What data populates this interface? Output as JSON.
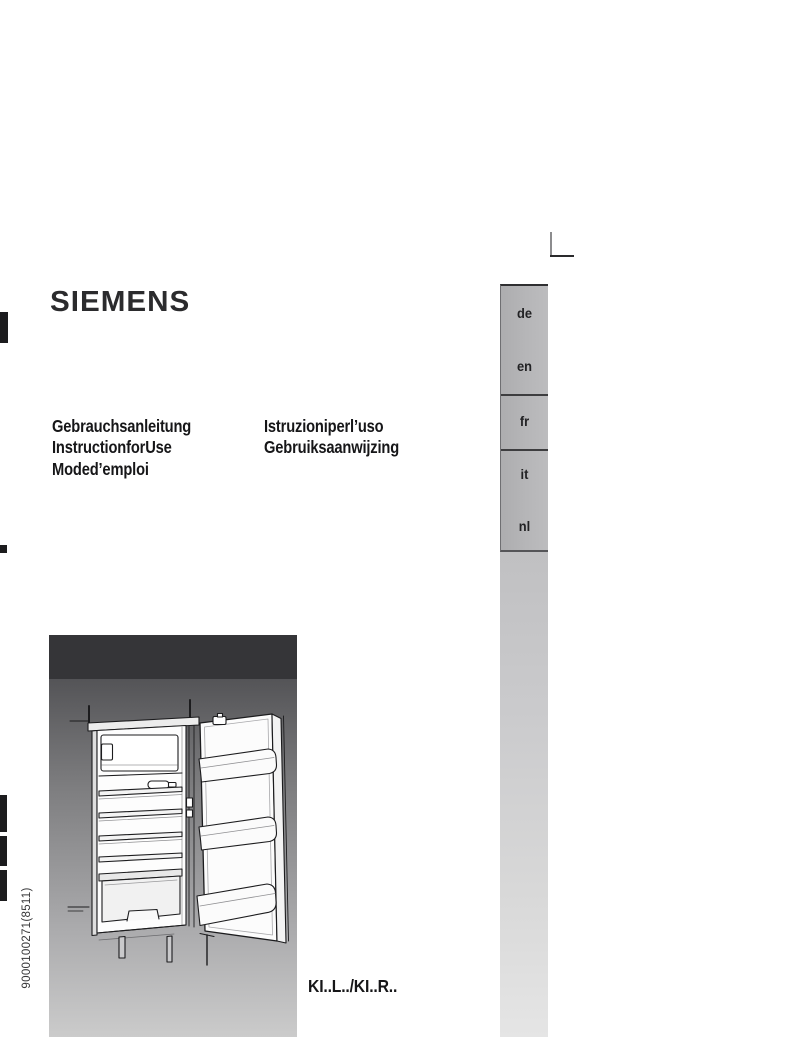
{
  "brand": {
    "logo_text": "SIEMENS"
  },
  "cover_titles": {
    "column1": [
      "Gebrauchsanleitung",
      "InstructionforUse",
      "Moded’emploi"
    ],
    "column2": [
      "Istruzioniperl’uso",
      "Gebruiksaanwijzing"
    ]
  },
  "language_sidebar": {
    "items": [
      "de",
      "en",
      "fr",
      "it",
      "nl"
    ]
  },
  "model_code": "KI..L../KI..R..",
  "document_number": "9000100271(8511)",
  "figure": {
    "alt": "Line drawing of an open built-in refrigerator with top freezer compartment, glass shelves, a lying bottle, vegetable drawer and three door storage bins"
  },
  "colors": {
    "tab_bar_gray": "#b4b4b6",
    "column_bottom_gray": "#e4e4e4",
    "figure_header": "#353538",
    "figure_bg_top": "#545457",
    "figure_bg_bottom": "#cbcbcb",
    "text": "#1a1a1c"
  }
}
